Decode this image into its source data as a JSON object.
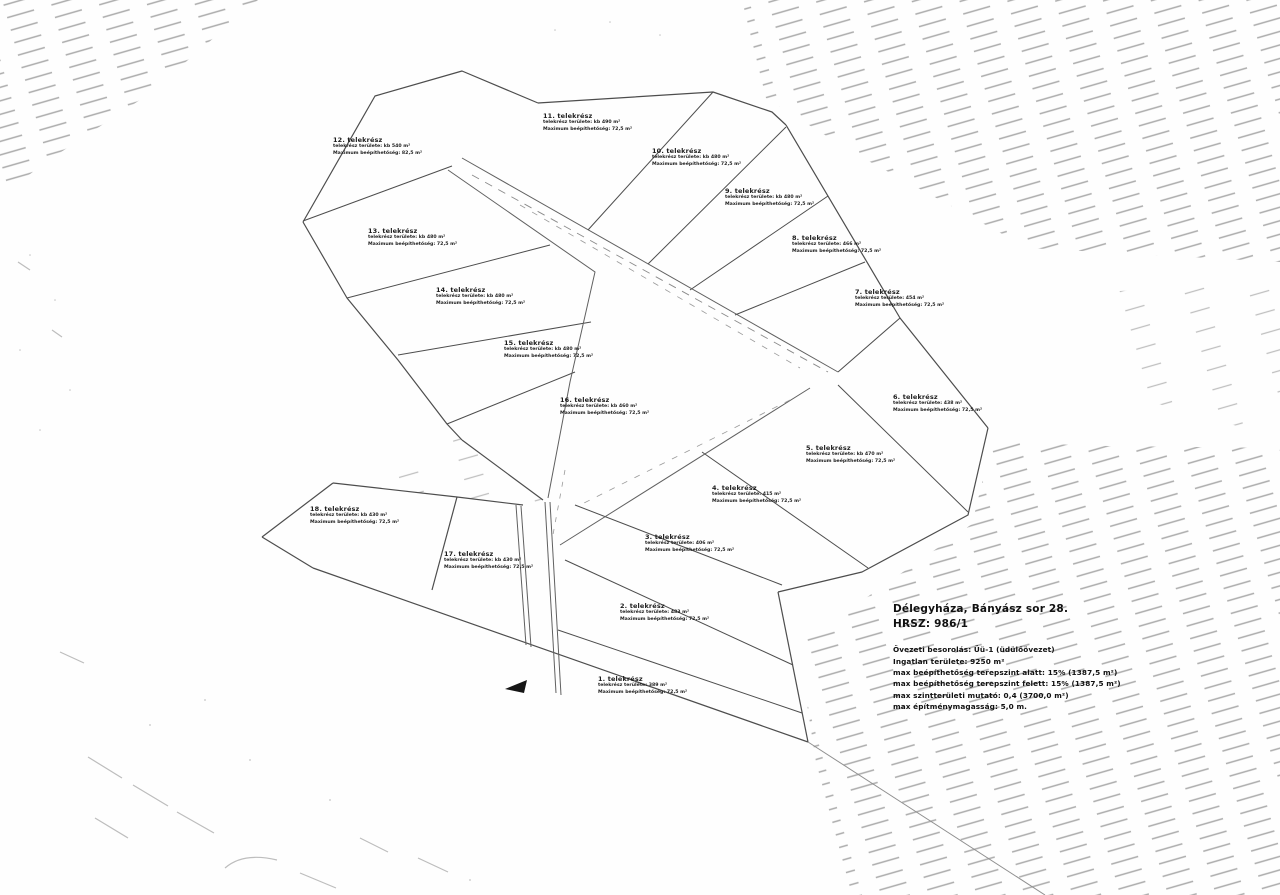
{
  "document": {
    "location_line1": "Délegyháza, Bányász sor 28.",
    "location_line2": "HRSZ: 986/1",
    "zoning": {
      "line1": "Övezeti besorolás: Üü-1 (üdülőövezet)",
      "line2": "Ingatlan területe: 9250 m²",
      "line3": "max beépíthetőség terepszint alatt: 15% (1387,5 m²)",
      "line4": "max beépíthetőség terepszint felett: 15% (1387,5 m²)",
      "line5": "max szintterületi mutató: 0,4 (3700,0 m²)",
      "line6": "max építménymagasság: 5,0 m."
    }
  },
  "icons": {
    "entrance_arrow": "left-filled-triangle"
  },
  "colors": {
    "drawing_line": "#4d4d4d",
    "road_line": "#606060",
    "hatch": "#ababab",
    "text": "#1c1c1c"
  },
  "plots": [
    {
      "title": "1. telekrész",
      "area_line": "telekrész területe: 389 m²",
      "coverage_line": "Maximum beépíthetőség: 72,5 m²"
    },
    {
      "title": "2. telekrész",
      "area_line": "telekrész területe: 483 m²",
      "coverage_line": "Maximum beépíthetőség: 72,5 m²"
    },
    {
      "title": "3. telekrész",
      "area_line": "telekrész területe: 406 m²",
      "coverage_line": "Maximum beépíthetőség: 72,5 m²"
    },
    {
      "title": "4. telekrész",
      "area_line": "telekrész területe: 415 m²",
      "coverage_line": "Maximum beépíthetőség: 72,5 m²"
    },
    {
      "title": "5. telekrész",
      "area_line": "telekrész területe: kb 470 m²",
      "coverage_line": "Maximum beépíthetőség: 72,5 m²"
    },
    {
      "title": "6. telekrész",
      "area_line": "telekrész területe: 438 m²",
      "coverage_line": "Maximum beépíthetőség: 72,5 m²"
    },
    {
      "title": "7. telekrész",
      "area_line": "telekrész területe: 454 m²",
      "coverage_line": "Maximum beépíthetőség: 72,5 m²"
    },
    {
      "title": "8. telekrész",
      "area_line": "telekrész területe: 466 m²",
      "coverage_line": "Maximum beépíthetőség: 72,5 m²"
    },
    {
      "title": "9. telekrész",
      "area_line": "telekrész területe: kb 480 m²",
      "coverage_line": "Maximum beépíthetőség: 72,5 m²"
    },
    {
      "title": "10. telekrész",
      "area_line": "telekrész területe: kb 480 m²",
      "coverage_line": "Maximum beépíthetőség: 72,5 m²"
    },
    {
      "title": "11. telekrész",
      "area_line": "telekrész területe: kb 490 m²",
      "coverage_line": "Maximum beépíthetőség: 72,5 m²"
    },
    {
      "title": "12. telekrész",
      "area_line": "telekrész területe: kb 540 m²",
      "coverage_line": "Maximum beépíthetőség: 82,5 m²"
    },
    {
      "title": "13. telekrész",
      "area_line": "telekrész területe: kb 480 m²",
      "coverage_line": "Maximum beépíthetőség: 72,5 m²"
    },
    {
      "title": "14. telekrész",
      "area_line": "telekrész területe: kb 480 m²",
      "coverage_line": "Maximum beépíthetőség: 72,5 m²"
    },
    {
      "title": "15. telekrész",
      "area_line": "telekrész területe: kb 480 m²",
      "coverage_line": "Maximum beépíthetőség: 72,5 m²"
    },
    {
      "title": "16. telekrész",
      "area_line": "telekrész területe: kb 460 m²",
      "coverage_line": "Maximum beépíthetőség: 72,5 m²"
    },
    {
      "title": "17. telekrész",
      "area_line": "telekrész területe: kb 430 m²",
      "coverage_line": "Maximum beépíthetőség: 72,5 m²"
    },
    {
      "title": "18. telekrész",
      "area_line": "telekrész területe: kb 430 m²",
      "coverage_line": "Maximum beépíthetőség: 72,5 m²"
    }
  ]
}
